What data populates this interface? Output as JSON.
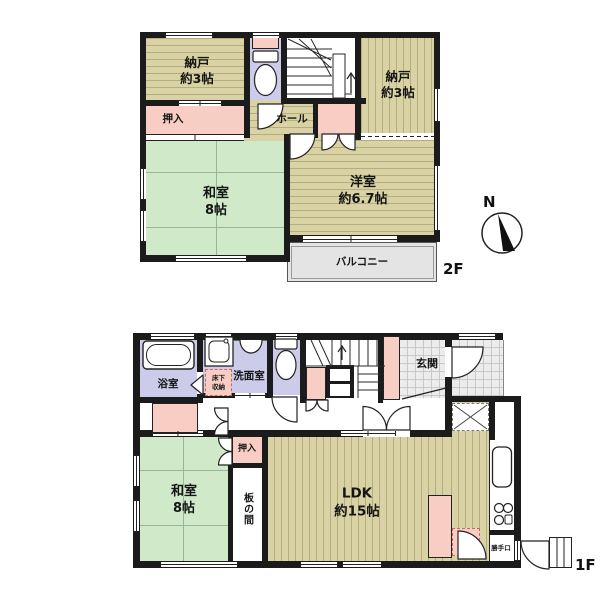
{
  "plan": {
    "floor2_label": "2F",
    "floor1_label": "1F",
    "compass_north": "N"
  },
  "floor2": {
    "nando_left": {
      "name": "納戸",
      "size": "約3帖"
    },
    "oshiire": "押入",
    "hall": "ホール",
    "nando_right": {
      "name": "納戸",
      "size": "約3帖"
    },
    "washitsu": {
      "name": "和室",
      "size": "8帖"
    },
    "youshitsu": {
      "name": "洋室",
      "size": "約6.7帖"
    },
    "balcony": "バルコニー"
  },
  "floor1": {
    "bathroom": "浴室",
    "washroom": "洗面室",
    "underfloor_storage": {
      "line1": "床下",
      "line2": "収納"
    },
    "genkan": "玄関",
    "oshiire": "押入",
    "washitsu": {
      "name": "和室",
      "size": "8帖"
    },
    "itanoma": "板の間",
    "ldk": {
      "name": "LDK",
      "size": "約15帖"
    },
    "kitchen_underfloor_storage": {
      "line1": "床下",
      "line2": "収納"
    },
    "katteguchi": "勝手口"
  },
  "colors": {
    "wall": "#1b1b1b",
    "wood": "#d9d2a4",
    "wood_line": "#b5ad7e",
    "tatami": "#cfe9c9",
    "tatami_line": "#97b897",
    "water": "#ccccea",
    "closet_pink": "#f8cdc3",
    "balcony": "#e4e4e4",
    "tile": "#ececec",
    "tile_line": "#c8c8c8"
  }
}
